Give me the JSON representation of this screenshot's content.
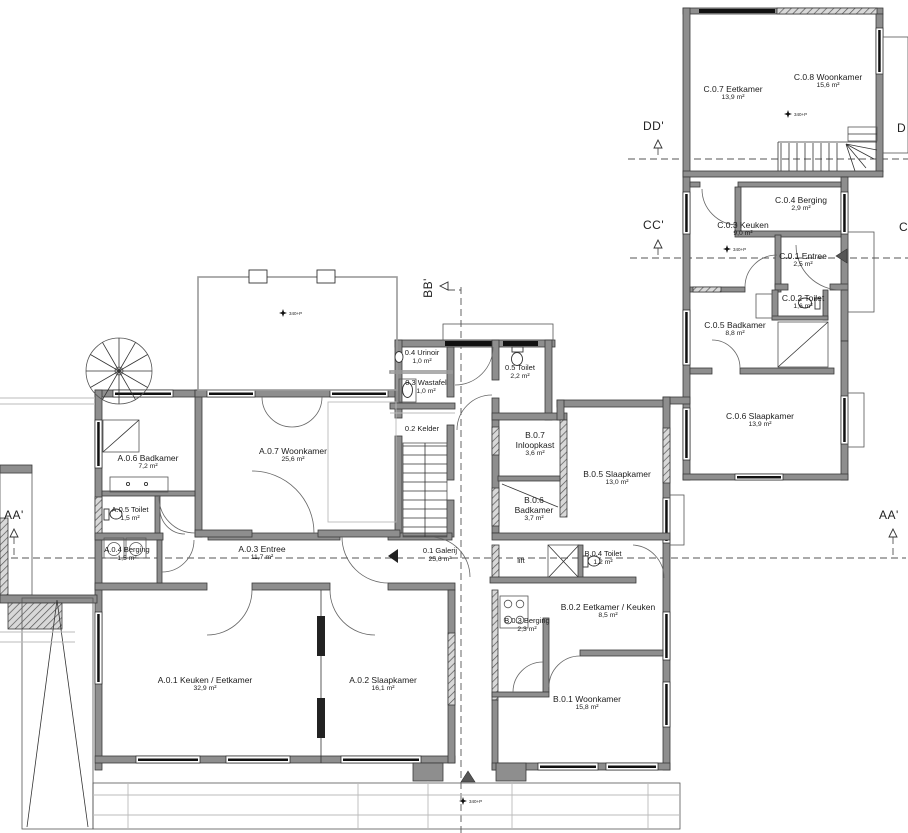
{
  "rooms": {
    "c07": {
      "label": "C.0.7 Eetkamer",
      "area": "13,9 m²"
    },
    "c08": {
      "label": "C.0.8 Woonkamer",
      "area": "15,6 m²"
    },
    "c04": {
      "label": "C.0.4 Berging",
      "area": "2,9 m²"
    },
    "c03": {
      "label": "C.0.3 Keuken",
      "area": "9,0 m²"
    },
    "c01": {
      "label": "C.0.1 Entree",
      "area": "2,5 m²"
    },
    "c02": {
      "label": "C.0.2 Toilet",
      "area": "1,6 m²"
    },
    "c05": {
      "label": "C.0.5 Badkamer",
      "area": "8,8 m²"
    },
    "c06": {
      "label": "C.0.6 Slaapkamer",
      "area": "13,9 m²"
    },
    "u04": {
      "label": "0.4 Urinoir",
      "area": "1,0 m²"
    },
    "t05": {
      "label": "0.5 Toilet",
      "area": "2,2 m²"
    },
    "w03": {
      "label": "0.3 Wastafel",
      "area": "1,0 m²"
    },
    "k02": {
      "label": "0.2 Kelder",
      "area": ""
    },
    "g01": {
      "label": "0.1 Galerij",
      "area": "25,6 m²"
    },
    "b07": {
      "code": "B.0.7",
      "name": "Inloopkast",
      "area": "3,6 m²"
    },
    "b05": {
      "label": "B.0.5 Slaapkamer",
      "area": "13,0 m²"
    },
    "b06": {
      "code": "B.0.6",
      "name": "Badkamer",
      "area": "3,7 m²"
    },
    "b04": {
      "label": "B.0.4 Toilet",
      "area": "1,2 m²"
    },
    "b02": {
      "label": "B.0.2 Eetkamer / Keuken",
      "area": "8,5 m²"
    },
    "b03": {
      "label": "B.0.3 Berging",
      "area": "2,3 m²"
    },
    "b01": {
      "label": "B.0.1 Woonkamer",
      "area": "15,8 m²"
    },
    "a06": {
      "label": "A.0.6 Badkamer",
      "area": "7,2 m²"
    },
    "a07": {
      "label": "A.0.7 Woonkamer",
      "area": "25,6 m²"
    },
    "a05": {
      "label": "A.0.5 Toilet",
      "area": "1,5 m²"
    },
    "a04": {
      "label": "A.0.4 Berging",
      "area": "1,5 m²"
    },
    "a03": {
      "label": "A.0.3 Entree",
      "area": "11,7 m²"
    },
    "a01": {
      "label": "A.0.1 Keuken / Eetkamer",
      "area": "32,9 m²"
    },
    "a02": {
      "label": "A.0.2 Slaapkamer",
      "area": "16,1 m²"
    },
    "lift": {
      "label": "lift",
      "area": ""
    }
  },
  "section_markers": {
    "aa": "AA'",
    "bb": "BB'",
    "cc": "CC'",
    "dd": "DD'",
    "d_edge": "D",
    "c_edge": "C"
  },
  "annotations": {
    "level": "340+P"
  }
}
